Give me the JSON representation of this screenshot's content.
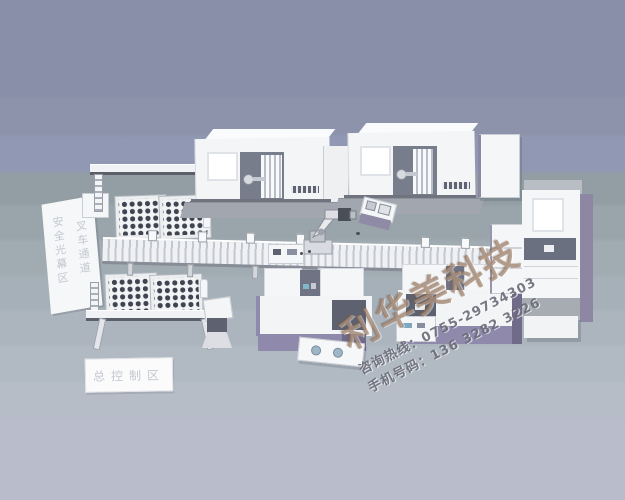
{
  "scene": {
    "description": "3D rendered layout of an automated CNC machining production line",
    "zone_labels": {
      "safety_light_curtain": "安全光幕区",
      "forklift_channel": "叉车通道",
      "master_control": "总控制区"
    },
    "watermark": {
      "brand": "利华美科技",
      "hotline": "咨询热线：0755-29734303",
      "mobile": "手机号码：136 3282 3226"
    },
    "trays": {
      "count": 4,
      "rows": 4,
      "cols": 5
    },
    "colors": {
      "background_top": "#898fa8",
      "background_bottom": "#babdcb",
      "machine_white": "#f5f6f8",
      "machine_base_gray": "#a2a7af",
      "machine_interior": "#787d8b",
      "accent_purple": "#8f8aab",
      "tray_part_dark": "#3f4450",
      "watermark_brand": "#96755c",
      "watermark_text": "#646773"
    }
  }
}
